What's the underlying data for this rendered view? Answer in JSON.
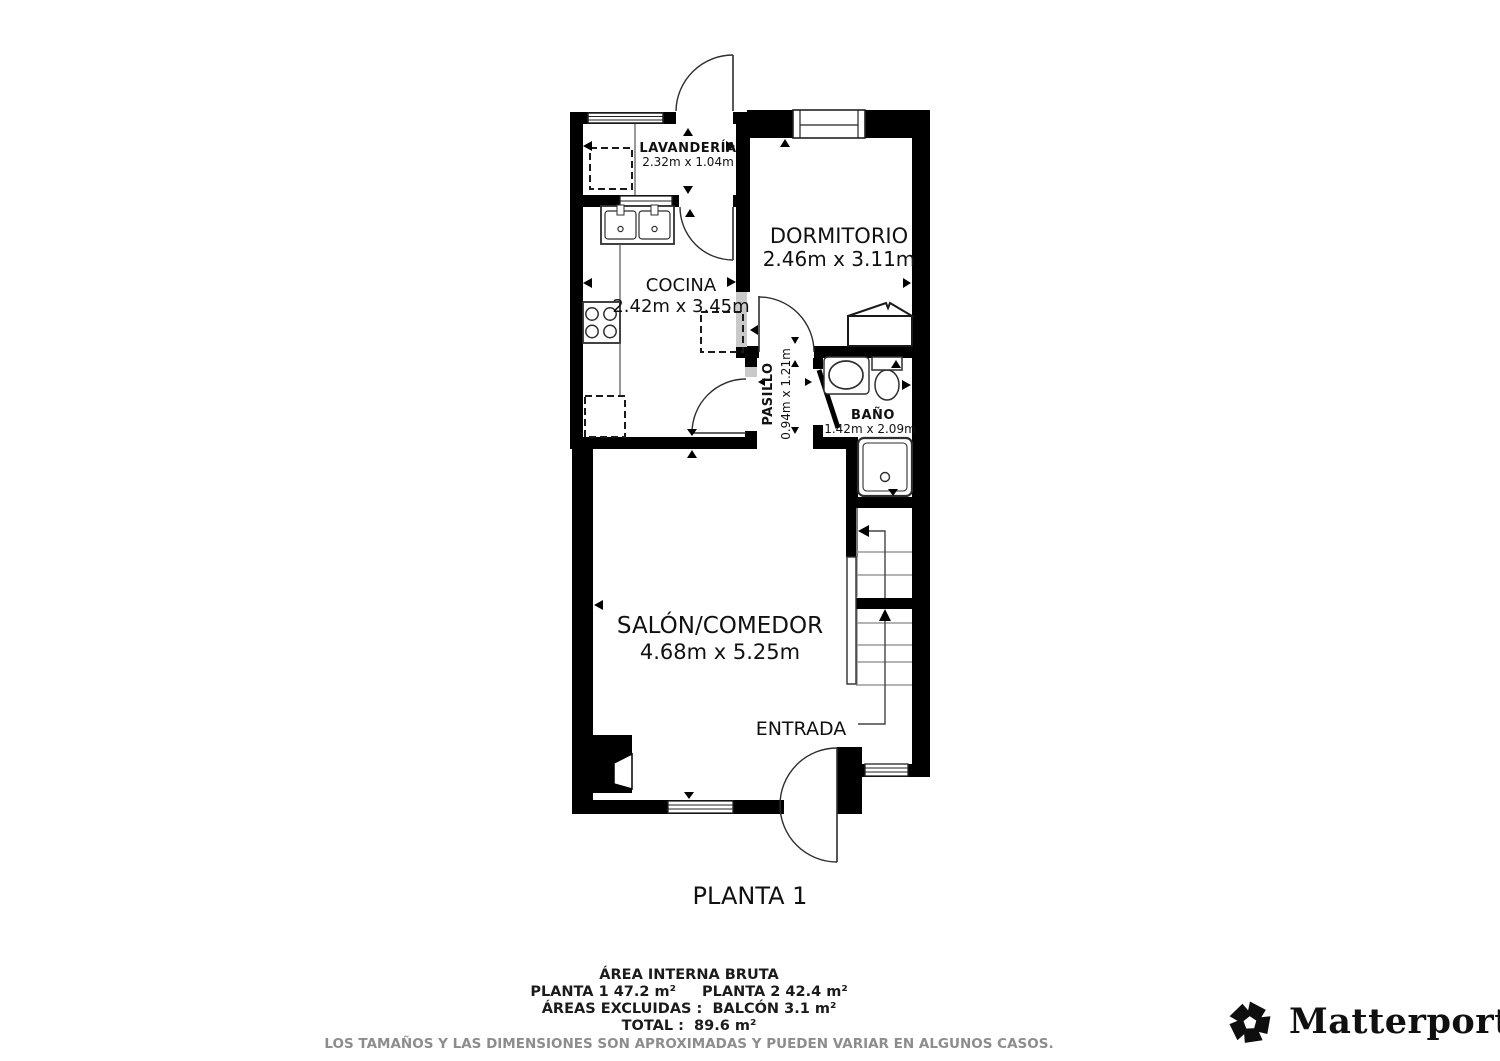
{
  "floor": {
    "label": "PLANTA 1"
  },
  "rooms": {
    "lavanderia": {
      "name": "LAVANDERÍA",
      "dims": "2.32m x 1.04m"
    },
    "dormitorio": {
      "name": "DORMITORIO",
      "dims": "2.46m x 3.11m"
    },
    "cocina": {
      "name": "COCINA",
      "dims": "2.42m x 3.45m"
    },
    "pasillo": {
      "name": "PASILLO",
      "dims": "0.94m x 1.21m"
    },
    "bano": {
      "name": "BAÑO",
      "dims": "1.42m x 2.09m"
    },
    "salon": {
      "name": "SALÓN/COMEDOR",
      "dims": "4.68m x 5.25m"
    },
    "entrada": {
      "name": "ENTRADA"
    }
  },
  "summary": {
    "heading": "ÁREA INTERNA BRUTA",
    "planta1": "PLANTA 1 47.2 m²",
    "planta2": "PLANTA 2 42.4 m²",
    "excluded": "ÁREAS EXCLUIDAS :  BALCÓN 3.1 m²",
    "total": "TOTAL :  89.6 m²",
    "disclaimer": "LOS TAMAÑOS Y LAS DIMENSIONES SON APROXIMADAS Y PUEDEN VARIAR EN ALGUNOS CASOS."
  },
  "branding": {
    "name": "Matterport",
    "registered": "®"
  },
  "colors": {
    "wall": "#000000",
    "line": "#2e2e2e",
    "step": "#9a9a9a",
    "threshold": "#c9c9c9",
    "text": "#111111",
    "muted": "#8d8d8d"
  }
}
